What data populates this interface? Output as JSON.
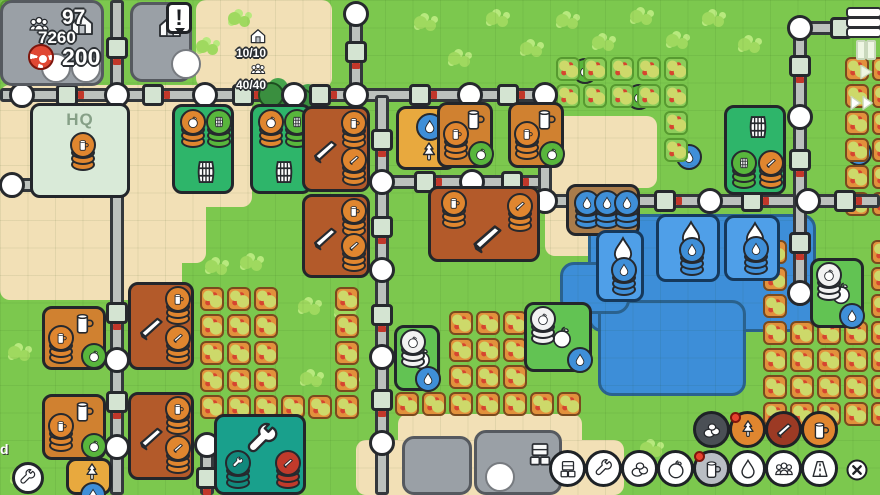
{
  "hud": {
    "population": "97",
    "production": "7260",
    "coins": "200",
    "housing": "10/10",
    "workers": "40/40",
    "alert": "!",
    "watermark": "d"
  },
  "hq_label": "HQ",
  "colors": {
    "grass": "#7cc84e",
    "sand": "#f2e0b6",
    "road": "#bcc1bd",
    "water": "#3d8ed8",
    "orange": "#e0862f",
    "green": "#58b63c",
    "blue": "#3f8fd8",
    "teal": "#12897c",
    "red": "#c03a2b",
    "brown_building": "#b35a2a",
    "cider_orange": "#d08130",
    "alert_red": "#e8432e",
    "fog_gray": "#9aa0a6"
  },
  "speed_controls": [
    {
      "icon": "menu-icon"
    },
    {
      "icon": "pause-icon"
    },
    {
      "icon": "play-icon"
    },
    {
      "icon": "fast-forward-icon"
    }
  ],
  "toolbar": {
    "resource_row": {
      "y": 411,
      "items": [
        {
          "icon": "stones",
          "style": "dark",
          "dot": false
        },
        {
          "icon": "tree",
          "style": "orange",
          "dot": true
        },
        {
          "icon": "plank",
          "style": "brown",
          "dot": false
        },
        {
          "icon": "mug",
          "style": "orange",
          "dot": false
        }
      ],
      "xs": [
        693,
        729,
        765,
        801
      ]
    },
    "build_row": {
      "y": 450,
      "items": [
        {
          "icon": "crates",
          "style": "white",
          "dot": false
        },
        {
          "icon": "wrench",
          "style": "white",
          "dot": false
        },
        {
          "icon": "stones",
          "style": "white",
          "dot": false
        },
        {
          "icon": "apple",
          "style": "white",
          "dot": false
        },
        {
          "icon": "mug",
          "style": "gray",
          "dot": true
        },
        {
          "icon": "drop",
          "style": "white",
          "dot": false
        },
        {
          "icon": "people",
          "style": "white",
          "dot": false
        },
        {
          "icon": "road",
          "style": "white",
          "dot": false
        }
      ],
      "xs": [
        549,
        585,
        621,
        657,
        693,
        729,
        765,
        801
      ]
    },
    "close": {
      "x": 845,
      "y": 458
    }
  },
  "map": {
    "sand": [
      [
        196,
        0,
        136,
        88
      ],
      [
        0,
        85,
        252,
        122
      ],
      [
        0,
        85,
        206,
        178
      ],
      [
        0,
        85,
        182,
        215
      ],
      [
        545,
        116,
        112,
        72
      ],
      [
        545,
        116,
        86,
        140
      ],
      [
        356,
        440,
        268,
        55
      ],
      [
        398,
        414,
        184,
        81
      ]
    ],
    "lake": [
      [
        588,
        214,
        228,
        118
      ],
      [
        598,
        300,
        148,
        96
      ],
      [
        560,
        262,
        70,
        52
      ]
    ],
    "roads": [
      [
        117,
        0,
        117,
        495
      ],
      [
        0,
        95,
        545,
        95
      ],
      [
        356,
        12,
        356,
        95
      ],
      [
        0,
        185,
        130,
        185
      ],
      [
        75,
        160,
        75,
        185
      ],
      [
        382,
        95,
        382,
        495
      ],
      [
        377,
        182,
        545,
        182
      ],
      [
        545,
        95,
        545,
        201
      ],
      [
        545,
        201,
        880,
        201
      ],
      [
        790,
        28,
        880,
        28
      ],
      [
        800,
        28,
        800,
        295
      ],
      [
        207,
        445,
        207,
        495
      ]
    ],
    "nodes_circle": [
      [
        22,
        95
      ],
      [
        117,
        95
      ],
      [
        205,
        95
      ],
      [
        294,
        95
      ],
      [
        356,
        95
      ],
      [
        470,
        95
      ],
      [
        545,
        95
      ],
      [
        356,
        14
      ],
      [
        12,
        185
      ],
      [
        117,
        185
      ],
      [
        117,
        360
      ],
      [
        117,
        447
      ],
      [
        382,
        182
      ],
      [
        382,
        270
      ],
      [
        382,
        357
      ],
      [
        382,
        443
      ],
      [
        472,
        182
      ],
      [
        545,
        201
      ],
      [
        710,
        201
      ],
      [
        808,
        201
      ],
      [
        800,
        28
      ],
      [
        800,
        117
      ],
      [
        800,
        293
      ],
      [
        207,
        445
      ]
    ],
    "nodes_sq_v": [
      [
        117,
        48
      ],
      [
        117,
        313
      ],
      [
        117,
        402
      ],
      [
        356,
        52
      ],
      [
        382,
        140
      ],
      [
        382,
        227
      ],
      [
        382,
        315
      ],
      [
        382,
        400
      ],
      [
        545,
        140
      ],
      [
        800,
        66
      ],
      [
        800,
        160
      ],
      [
        800,
        243
      ],
      [
        207,
        478
      ]
    ],
    "nodes_sq_h": [
      [
        67,
        95
      ],
      [
        153,
        95
      ],
      [
        243,
        95
      ],
      [
        320,
        95
      ],
      [
        420,
        95
      ],
      [
        508,
        95
      ],
      [
        70,
        185
      ],
      [
        425,
        182
      ],
      [
        512,
        182
      ],
      [
        665,
        201
      ],
      [
        752,
        201
      ],
      [
        845,
        201
      ],
      [
        841,
        28
      ]
    ],
    "fields": [
      {
        "x0": 200,
        "y0": 287,
        "c": 6,
        "r": 5,
        "p": 27,
        "v": "o",
        "skip": [
          3,
          4,
          9,
          10,
          15,
          16,
          21,
          22
        ]
      },
      {
        "x0": 395,
        "y0": 311,
        "c": 8,
        "r": 4,
        "p": 27,
        "v": "o",
        "skip": [
          0,
          1,
          5,
          6,
          7,
          8,
          9,
          13,
          14,
          15,
          16,
          17,
          21,
          22,
          23,
          31
        ]
      },
      {
        "x0": 763,
        "y0": 240,
        "c": 5,
        "r": 7,
        "p": 27,
        "v": "o",
        "skip": [
          1,
          2,
          3,
          6,
          7,
          8,
          11,
          12,
          13
        ]
      },
      {
        "x0": 556,
        "y0": 57,
        "c": 5,
        "r": 4,
        "p": 27,
        "v": "g",
        "skip": [
          10,
          11,
          12,
          13,
          15,
          16,
          17,
          18
        ]
      },
      {
        "x0": 845,
        "y0": 57,
        "c": 2,
        "r": 6,
        "p": 27,
        "v": "o",
        "skip": []
      }
    ],
    "minis": [
      {
        "i": "apple",
        "c": "green",
        "x": 572,
        "y": 58
      },
      {
        "i": "apple",
        "c": "green",
        "x": 626,
        "y": 84
      },
      {
        "i": "drop",
        "c": "blue",
        "x": 676,
        "y": 144
      },
      {
        "i": "drop",
        "c": "blue",
        "x": 846,
        "y": 140
      }
    ],
    "clovers": [
      [
        168,
        16
      ],
      [
        196,
        40
      ],
      [
        228,
        12
      ],
      [
        414,
        16
      ],
      [
        448,
        52
      ],
      [
        486,
        12
      ],
      [
        520,
        42
      ],
      [
        556,
        14
      ],
      [
        592,
        36
      ],
      [
        630,
        10
      ],
      [
        666,
        34
      ],
      [
        702,
        12
      ],
      [
        738,
        38
      ],
      [
        298,
        300
      ],
      [
        334,
        304
      ],
      [
        300,
        372
      ],
      [
        336,
        376
      ],
      [
        8,
        346
      ],
      [
        10,
        470
      ],
      [
        205,
        260
      ],
      [
        240,
        256
      ],
      [
        700,
        432
      ],
      [
        640,
        442
      ]
    ],
    "trees": [
      [
        258,
        82
      ],
      [
        288,
        88
      ]
    ],
    "green_corner": [
      0,
      0,
      30,
      30
    ],
    "buildings": [
      {
        "t": "hq",
        "x": 30,
        "y": 103,
        "w": 100,
        "h": 95
      },
      {
        "t": "barrelhouse",
        "x": 172,
        "y": 104,
        "w": 62,
        "h": 90
      },
      {
        "t": "barrelhouse",
        "x": 250,
        "y": 104,
        "w": 62,
        "h": 90
      },
      {
        "t": "lumber",
        "x": 302,
        "y": 106,
        "w": 68,
        "h": 86
      },
      {
        "t": "forester",
        "x": 396,
        "y": 106,
        "w": 60,
        "h": 64
      },
      {
        "t": "cider",
        "x": 437,
        "y": 102,
        "w": 56,
        "h": 66
      },
      {
        "t": "cider",
        "x": 508,
        "y": 102,
        "w": 56,
        "h": 66
      },
      {
        "t": "lumber",
        "x": 302,
        "y": 194,
        "w": 68,
        "h": 84
      },
      {
        "t": "lumberbig",
        "x": 428,
        "y": 186,
        "w": 112,
        "h": 76
      },
      {
        "t": "collector",
        "x": 566,
        "y": 184,
        "w": 74,
        "h": 52
      },
      {
        "t": "barrelmaker",
        "x": 724,
        "y": 105,
        "w": 62,
        "h": 90
      },
      {
        "t": "well",
        "x": 596,
        "y": 230,
        "w": 48,
        "h": 72
      },
      {
        "t": "well",
        "x": 656,
        "y": 214,
        "w": 64,
        "h": 68
      },
      {
        "t": "well",
        "x": 724,
        "y": 215,
        "w": 56,
        "h": 66
      },
      {
        "t": "orchardhut",
        "x": 394,
        "y": 325,
        "w": 46,
        "h": 66
      },
      {
        "t": "orchardhut",
        "x": 524,
        "y": 302,
        "w": 68,
        "h": 70
      },
      {
        "t": "orchardhut",
        "x": 810,
        "y": 258,
        "w": 54,
        "h": 70
      },
      {
        "t": "toolsmith",
        "x": 214,
        "y": 414,
        "w": 92,
        "h": 81
      },
      {
        "t": "cider",
        "x": 42,
        "y": 306,
        "w": 64,
        "h": 64
      },
      {
        "t": "cider",
        "x": 42,
        "y": 394,
        "w": 64,
        "h": 66
      },
      {
        "t": "lumber",
        "x": 128,
        "y": 282,
        "w": 66,
        "h": 88
      },
      {
        "t": "lumber",
        "x": 128,
        "y": 392,
        "w": 66,
        "h": 88
      },
      {
        "t": "forester2",
        "x": 66,
        "y": 458,
        "w": 46,
        "h": 37
      }
    ],
    "fog_tiles": [
      {
        "x": 0,
        "y": 0,
        "w": 104,
        "h": 86,
        "ic": [
          "house",
          "circle",
          "circle"
        ]
      },
      {
        "x": 130,
        "y": 2,
        "w": 62,
        "h": 80,
        "ic": [
          "house",
          "circle"
        ]
      },
      {
        "x": 402,
        "y": 436,
        "w": 70,
        "h": 59,
        "ic": []
      },
      {
        "x": 474,
        "y": 430,
        "w": 88,
        "h": 65,
        "ic": [
          "circle",
          "crates"
        ]
      }
    ],
    "alert_bubble": {
      "x": 166,
      "y": 2
    },
    "wrench_bubble": {
      "x": 12,
      "y": 462
    }
  }
}
